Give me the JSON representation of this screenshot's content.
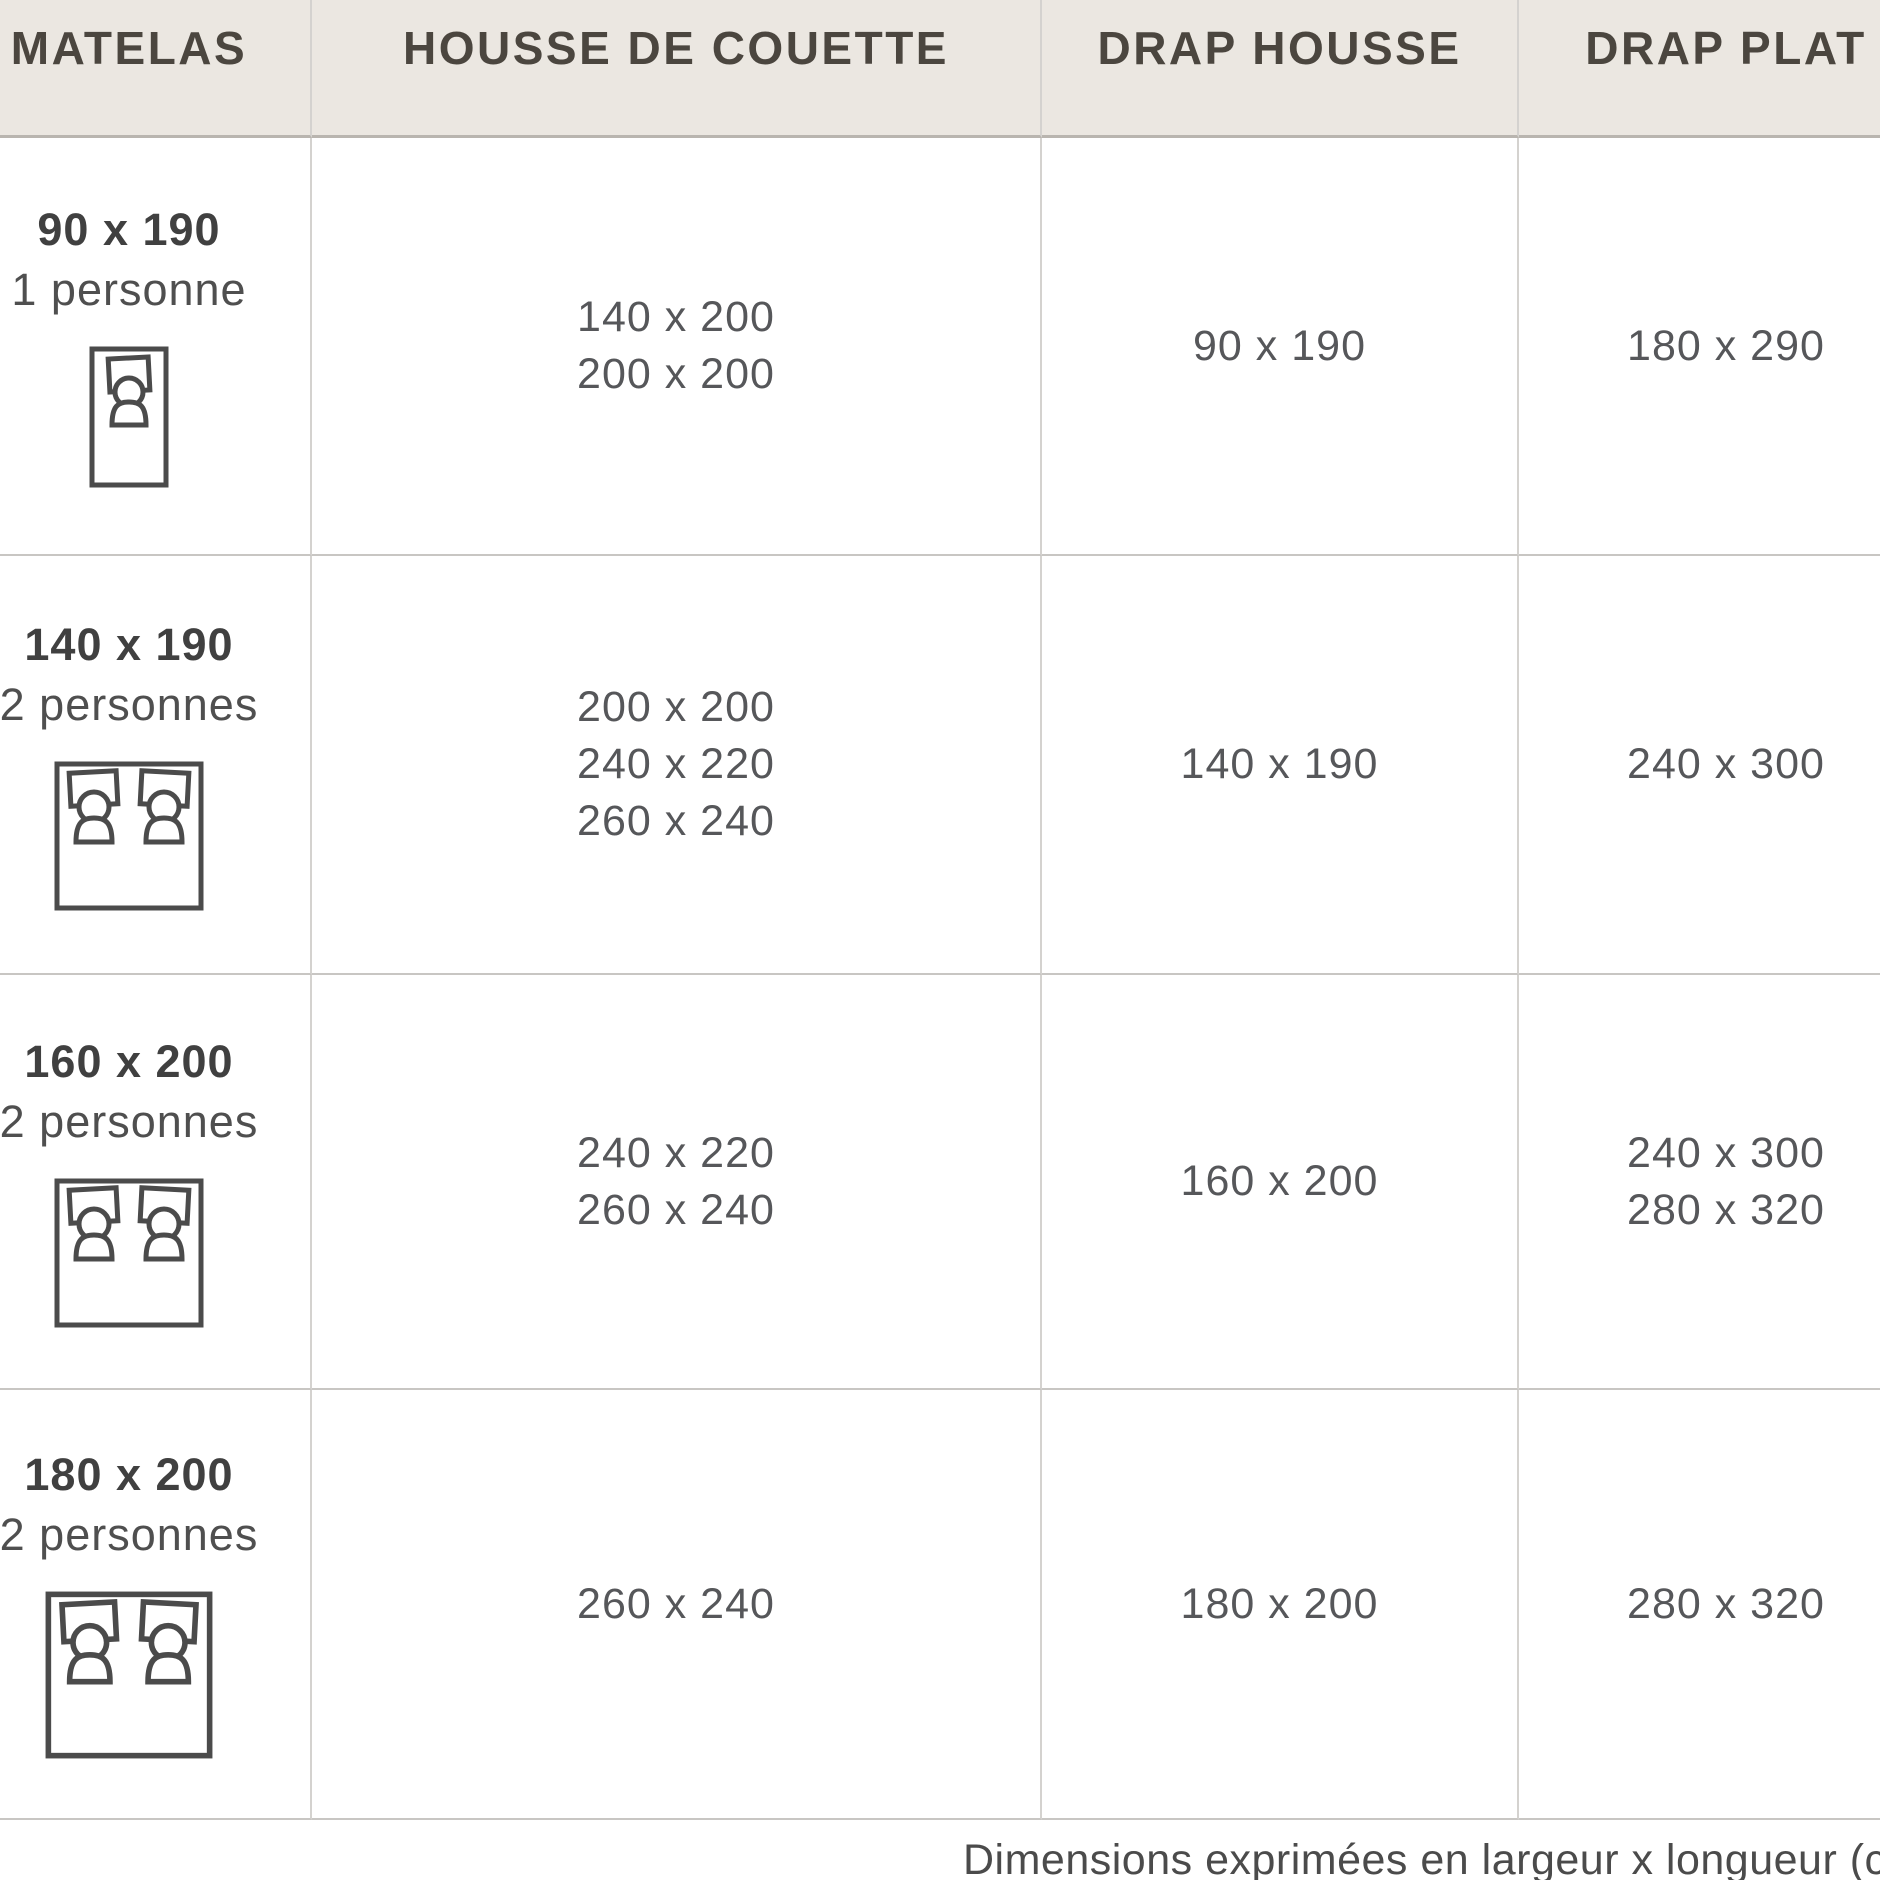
{
  "page": {
    "type": "bedding-size-guide-table"
  },
  "table": {
    "columns": [
      {
        "id": "matelas",
        "label": "MATELAS"
      },
      {
        "id": "housse_de_couette",
        "label": "HOUSSE DE COUETTE"
      },
      {
        "id": "drap_housse",
        "label": "DRAP HOUSSE"
      },
      {
        "id": "drap_plat",
        "label": "DRAP PLAT"
      }
    ],
    "rows": [
      {
        "matelas_size": "90 x 190",
        "persons_label": "1 personne",
        "bed_icon": "single-bed-icon",
        "housse_de_couette": [
          "140 x 200",
          "200 x 200"
        ],
        "drap_housse": [
          "90 x 190"
        ],
        "drap_plat": [
          "180 x 290"
        ]
      },
      {
        "matelas_size": "140 x 190",
        "persons_label": "2 personnes",
        "bed_icon": "double-bed-icon",
        "housse_de_couette": [
          "200 x 200",
          "240 x 220",
          "260 x 240"
        ],
        "drap_housse": [
          "140 x 190"
        ],
        "drap_plat": [
          "240 x 300"
        ]
      },
      {
        "matelas_size": "160 x 200",
        "persons_label": "2 personnes",
        "bed_icon": "double-bed-icon",
        "housse_de_couette": [
          "240 x 220",
          "260 x 240"
        ],
        "drap_housse": [
          "160 x 200"
        ],
        "drap_plat": [
          "240 x 300",
          "280 x 320"
        ]
      },
      {
        "matelas_size": "180 x 200",
        "persons_label": "2 personnes",
        "bed_icon": "double-bed-icon",
        "housse_de_couette": [
          "260 x 240"
        ],
        "drap_housse": [
          "180 x 200"
        ],
        "drap_plat": [
          "280 x 320"
        ]
      }
    ]
  },
  "footnote": "Dimensions exprimées en largeur x longueur (cm",
  "colors": {
    "header_bg": "#EBE7E1",
    "header_text": "#4B463F",
    "value_text": "#56575A",
    "label_text": "#404040",
    "vertical_border": "#D4D2CF",
    "horizontal_border": "#C8C6C3",
    "icon_stroke": "#4B4B4B",
    "footnote_text": "#4B4B4B"
  }
}
